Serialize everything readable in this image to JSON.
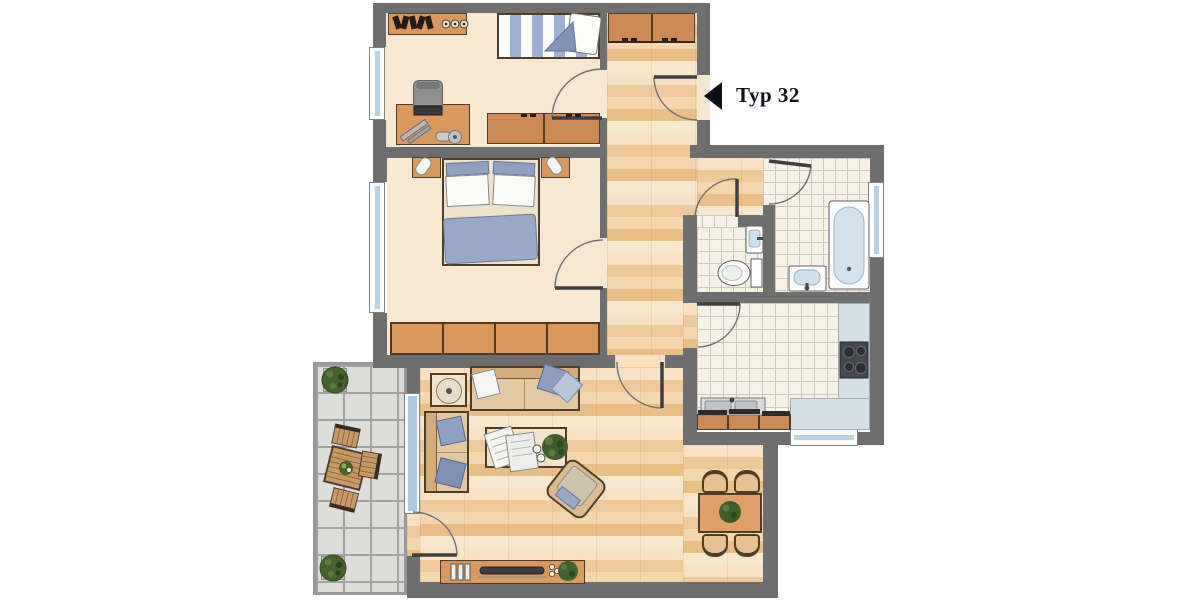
{
  "plan": {
    "label": "Typ 32",
    "arrow_icon": "left-black-triangle-entrance-marker",
    "rooms": [
      "children-room",
      "bedroom",
      "living-room",
      "dining-area",
      "hallway",
      "wc",
      "bathroom",
      "kitchen",
      "balcony"
    ],
    "colors": {
      "wall": "#6e6e6e",
      "room_floor": "#f9e8d1",
      "parquet": "#f0cf9f",
      "tile": "#f7f2e8",
      "tile_grout": "#cfc8b8",
      "balcony_tile": "#dddddb",
      "balcony_grout": "#a2a2a0",
      "furniture_wood": "#d8985e",
      "cabinet_wood": "#cd8a54",
      "textile_blue": "#8e9dbf",
      "kitchen_counter": "#d4dfe6",
      "window_glass": "#b9d2e2",
      "plant_green": "#44612e",
      "stove_dark": "#45484c",
      "label_color": "#12121e"
    }
  }
}
